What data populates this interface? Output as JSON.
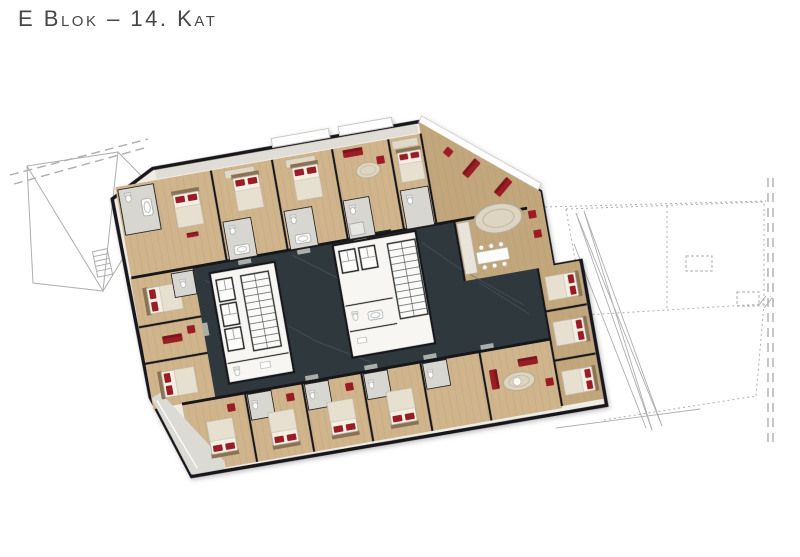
{
  "header": {
    "title": "E Blok – 14. Kat"
  },
  "floor_plan": {
    "block": "E",
    "floor": "14. Kat",
    "palette": {
      "background": "#ffffff",
      "title_text": "#474747",
      "wall": "#17191b",
      "corridor_floor": "#2f373c",
      "wood_floor": "#cfb48c",
      "wood_floor_dark": "#c2a67c",
      "bathroom_floor": "#d8d6d1",
      "core_white": "#f7f6f3",
      "accent_red": "#9c1f28",
      "terrace": "#dcdad4",
      "adjacent_outline": "#aeaeae"
    }
  }
}
